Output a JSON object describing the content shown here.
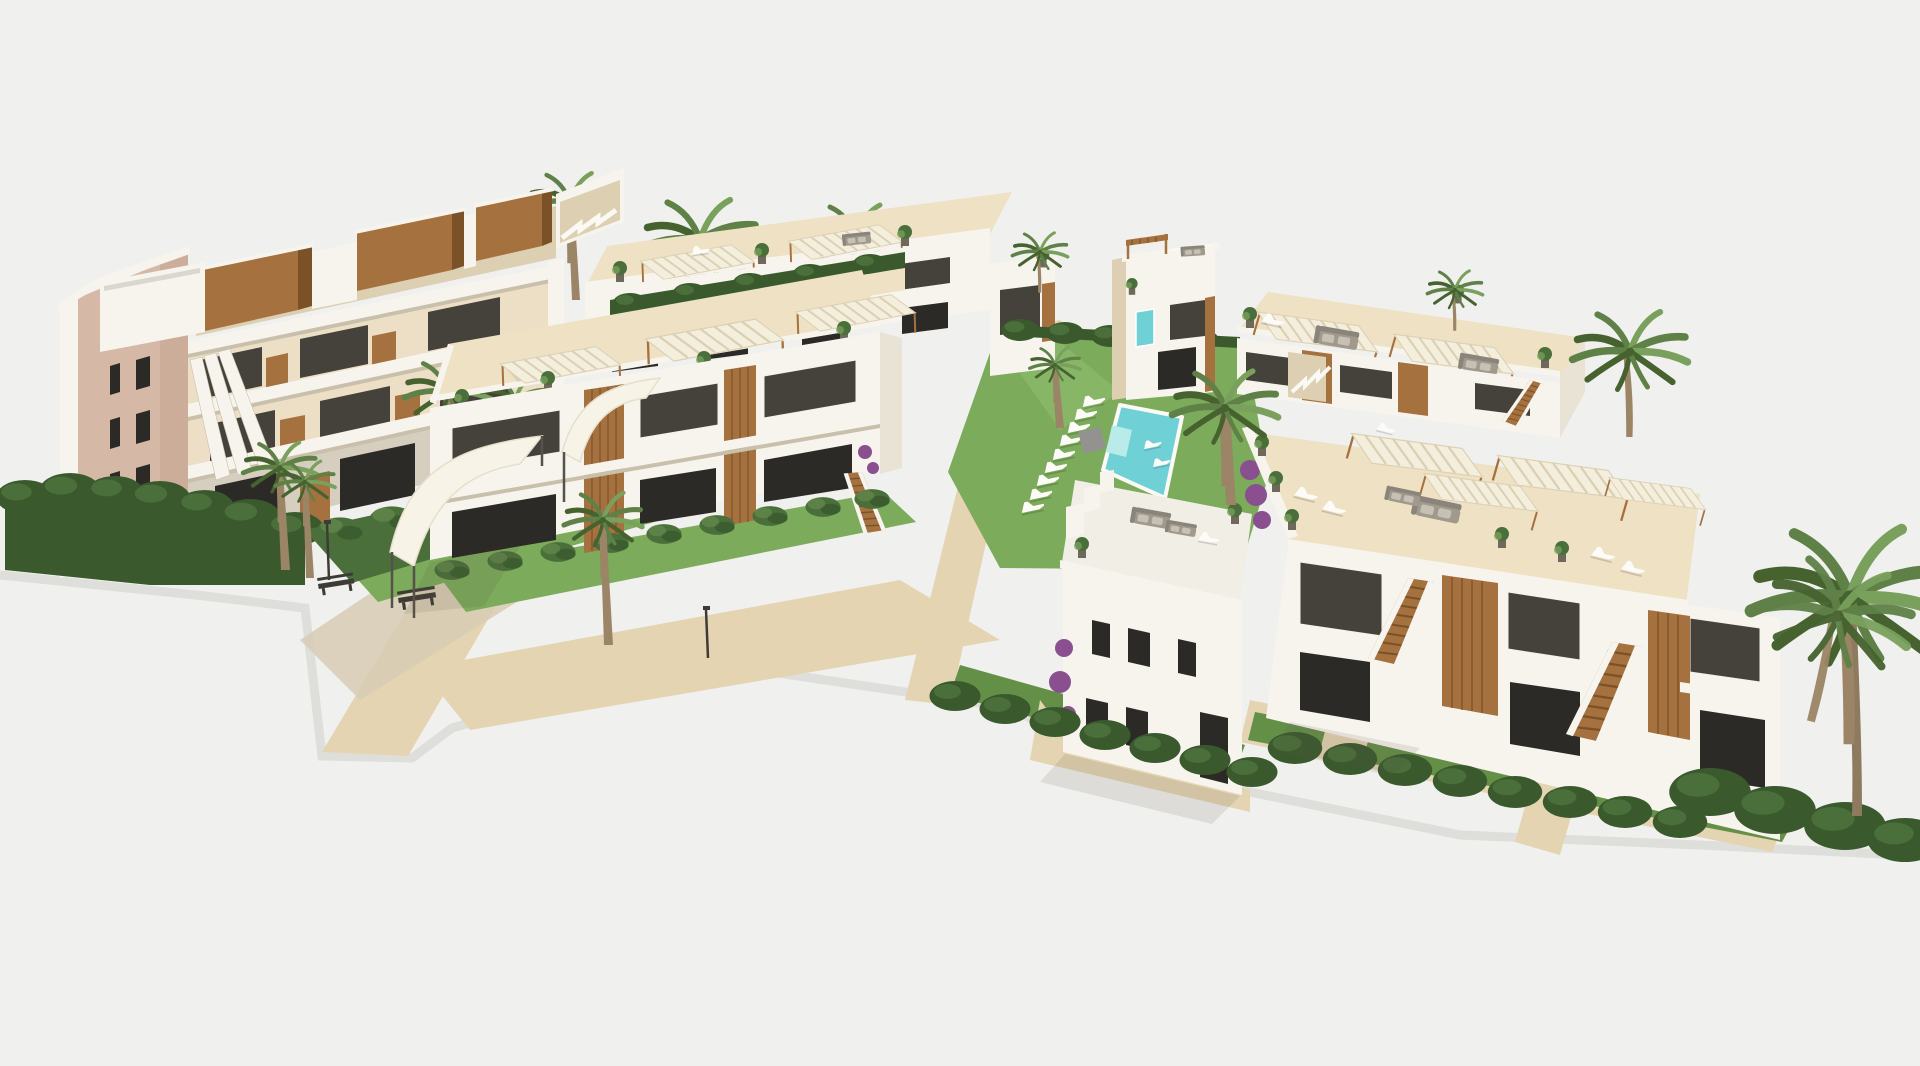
{
  "scene": {
    "title": "3D architectural rendering of a Mediterranean residential development",
    "description": "Aerial perspective render of a new-build residential complex: a stepped four-storey apartment block with wood-clad roof pergolas on the left, rows of two-storey white bungalows with rooftop terraces, pergola canopies, sofas and sun loungers in the centre and right, a communal lawn with a turquoise swimming pool and a row of white sun loungers, a small pool-house tower with turquoise glazing, a plain white gable house, sandy walkways with shade sails and benches, green hedges, lawns and palm trees, all on a plain light-grey background."
  },
  "palette": {
    "bg": "#f0f0ee",
    "ground-edge": "#dcddd8",
    "wall-white": "#f7f4ee",
    "wall-white-shade": "#e9e3d6",
    "wall-shadow": "#d6cfbf",
    "wall-cream": "#ecdfc6",
    "wall-cream-dark": "#dccfb2",
    "soffit": "#c9c0ab",
    "gable-pink": "#d5b9a6",
    "gable-pink-dark": "#c3a48e",
    "wood": "#a5713f",
    "wood-dark": "#7b5228",
    "glass": "#45423b",
    "glass-dark": "#2c2a26",
    "grass": "#7cab5b",
    "grass-dark": "#648f47",
    "grass-light": "#8cbb6b",
    "hedge": "#4a6f3a",
    "hedge-dark": "#3a5a2e",
    "palm": "#5f8148",
    "palm-dark": "#46622f",
    "palm-light": "#79a05c",
    "trunk": "#9b8566",
    "pool": "#6fd0d5",
    "pool-light": "#b9ebe8",
    "sand": "#e4d4b2",
    "sand-light": "#eee1c4",
    "paver": "#d7cbb4",
    "canopy": "#f4eedd",
    "canopy-stripe": "#dbd0b4",
    "lounger": "#fcfbf7",
    "sofa": "#a09a8d",
    "sofa-dark": "#8a847a",
    "cushion": "#c6c1b4",
    "bench": "#3e3b36",
    "purple": "#8a4f8e",
    "roof-grey": "#d9d7cf",
    "pot": "#6e685d"
  }
}
